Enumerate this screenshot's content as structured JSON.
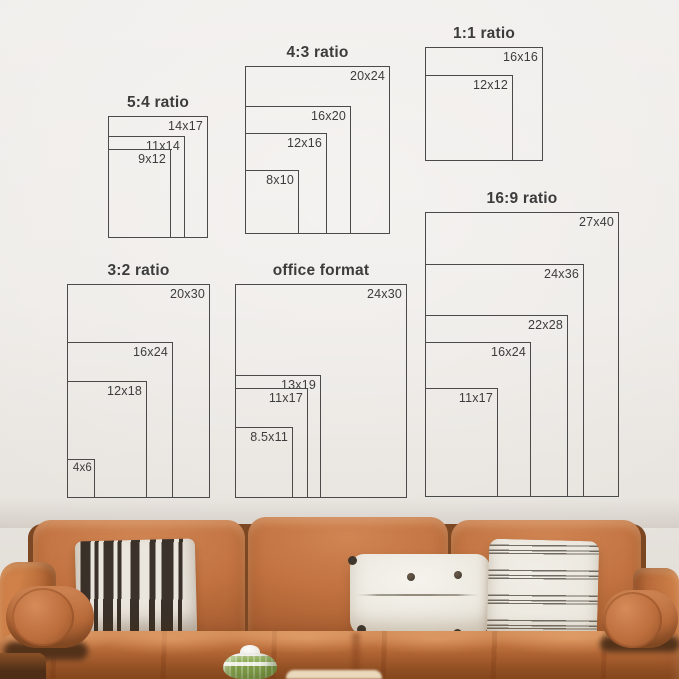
{
  "size_guide": {
    "groups": [
      {
        "title": "5:4 ratio",
        "sizes": [
          {
            "label": "14x17"
          },
          {
            "label": "11x14"
          },
          {
            "label": "9x12"
          }
        ]
      },
      {
        "title": "4:3 ratio",
        "sizes": [
          {
            "label": "20x24"
          },
          {
            "label": "16x20"
          },
          {
            "label": "12x16"
          },
          {
            "label": "8x10"
          }
        ]
      },
      {
        "title": "1:1 ratio",
        "sizes": [
          {
            "label": "16x16"
          },
          {
            "label": "12x12"
          }
        ]
      },
      {
        "title": "3:2 ratio",
        "sizes": [
          {
            "label": "20x30"
          },
          {
            "label": "16x24"
          },
          {
            "label": "12x18"
          },
          {
            "label": "4x6"
          }
        ]
      },
      {
        "title": "office format",
        "sizes": [
          {
            "label": "24x30"
          },
          {
            "label": "13x19"
          },
          {
            "label": "11x17"
          },
          {
            "label": "8.5x11"
          }
        ]
      },
      {
        "title": "16:9 ratio",
        "sizes": [
          {
            "label": "27x40"
          },
          {
            "label": "24x36"
          },
          {
            "label": "22x28"
          },
          {
            "label": "16x24"
          },
          {
            "label": "11x17"
          }
        ]
      }
    ]
  },
  "palette": {
    "diagram_line": "#4a4a4a",
    "diagram_text": "#3c3c3c",
    "wall": "#edeae6",
    "sofa_leather": "#b96b3a",
    "sofa_leather_light": "#d08553",
    "sofa_leather_dark": "#8f5127",
    "pillow_stripe_dark": "#3a322b",
    "pillow_offwhite": "#ebe6dd",
    "pillow_gray_stripe": "#726b61",
    "vase_green": "#7e9c46",
    "table_cream": "#ead9bd"
  }
}
